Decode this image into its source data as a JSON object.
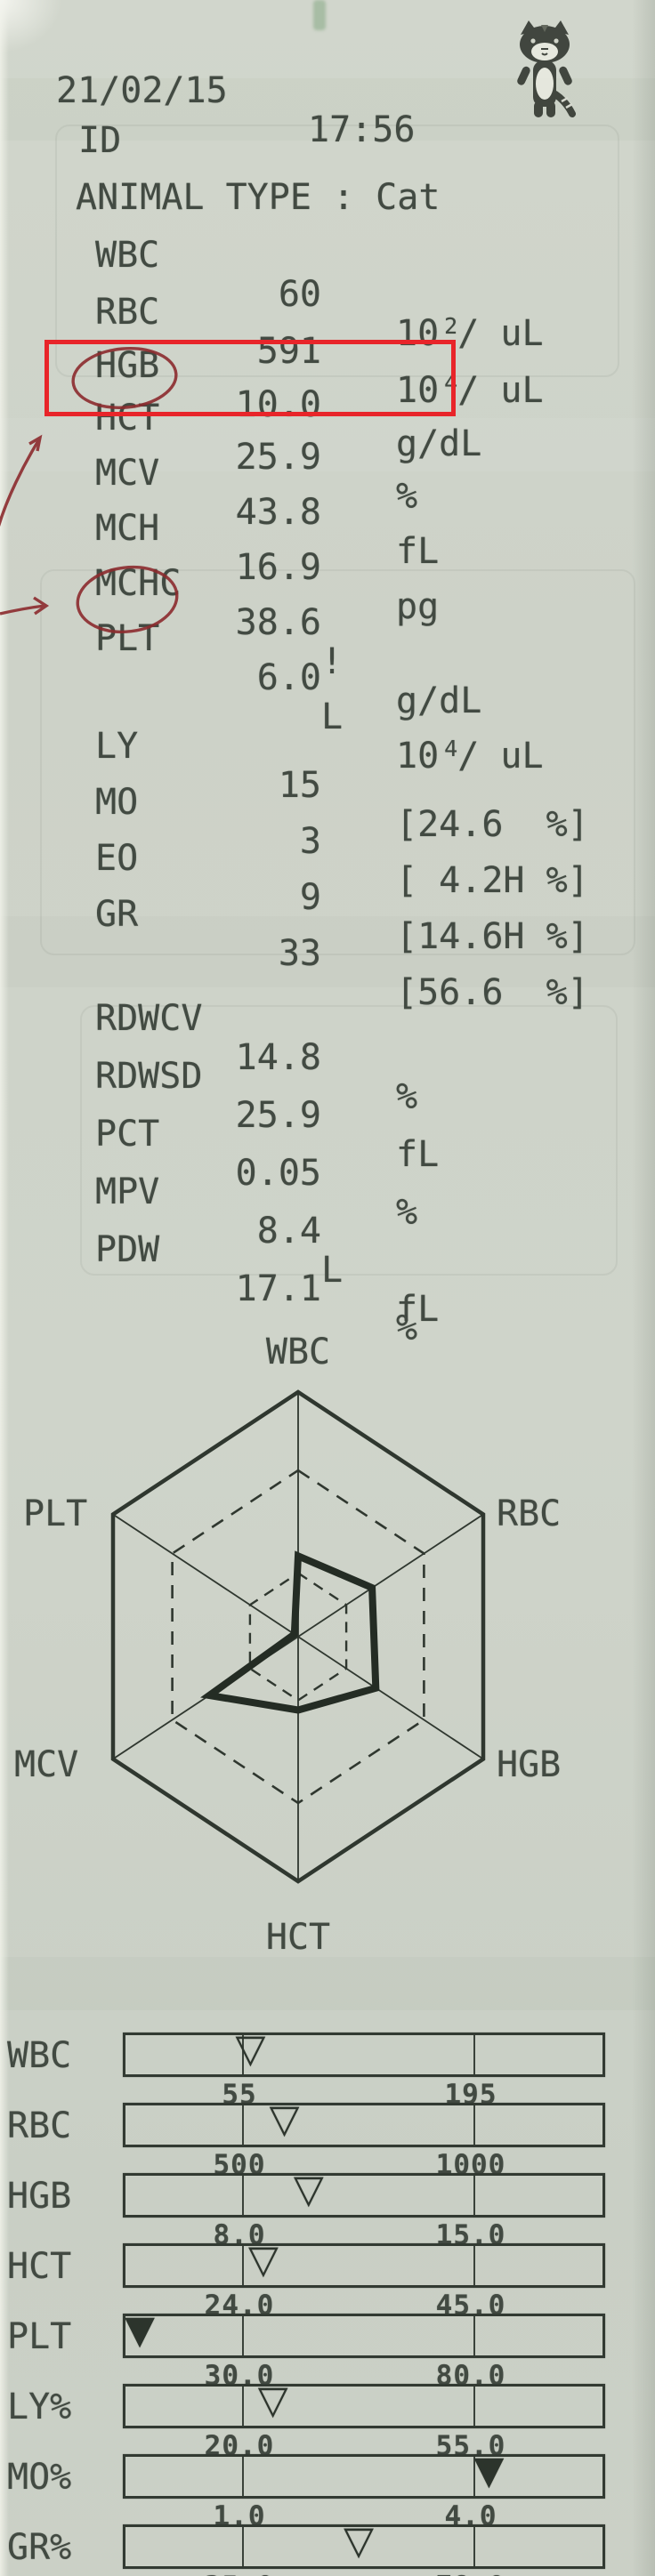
{
  "palette": {
    "paper": "#cdd2c8",
    "ink": "#424a42",
    "line_ink": "#323a32",
    "highlight_red": "#e8252a",
    "pen_dark_red": "#8c2b2e"
  },
  "header": {
    "date": "21/02/15",
    "time": "17:56",
    "mascot": "cat-mascot-stamp"
  },
  "id_line": {
    "label": "ID"
  },
  "animal_line": {
    "text": "ANIMAL TYPE : Cat"
  },
  "cbc_rows": [
    {
      "label": "WBC",
      "value": "60",
      "flag": "",
      "unit_base": "10",
      "unit_sup": "2",
      "unit_rest": "/ uL",
      "unit_text": ""
    },
    {
      "label": "RBC",
      "value": "591",
      "flag": "",
      "unit_base": "10",
      "unit_sup": "4",
      "unit_rest": "/ uL",
      "unit_text": ""
    },
    {
      "label": "HGB",
      "value": "10.0",
      "flag": "",
      "unit_base": "",
      "unit_sup": "",
      "unit_rest": "",
      "unit_text": "g/dL"
    },
    {
      "label": "HCT",
      "value": "25.9",
      "flag": "",
      "unit_base": "",
      "unit_sup": "",
      "unit_rest": "",
      "unit_text": "%"
    },
    {
      "label": "MCV",
      "value": "43.8",
      "flag": "",
      "unit_base": "",
      "unit_sup": "",
      "unit_rest": "",
      "unit_text": "fL"
    },
    {
      "label": "MCH",
      "value": "16.9",
      "flag": "",
      "unit_base": "",
      "unit_sup": "",
      "unit_rest": "",
      "unit_text": "pg"
    },
    {
      "label": "MCHC",
      "value": "38.6",
      "flag": "!",
      "unit_base": "",
      "unit_sup": "",
      "unit_rest": "",
      "unit_text": "g/dL"
    },
    {
      "label": "PLT",
      "value": "6.0",
      "flag": "L",
      "unit_base": "10",
      "unit_sup": "4",
      "unit_rest": "/ uL",
      "unit_text": ""
    }
  ],
  "diff_rows": [
    {
      "label": "LY",
      "value": "15",
      "bracket": "[24.6  %]"
    },
    {
      "label": "MO",
      "value": "3",
      "bracket": "[ 4.2H %]"
    },
    {
      "label": "EO",
      "value": "9",
      "bracket": "[14.6H %]"
    },
    {
      "label": "GR",
      "value": "33",
      "bracket": "[56.6  %]"
    }
  ],
  "extra_rows": [
    {
      "label": "RDWCV",
      "value": "14.8",
      "flag": "",
      "unit_text": "%"
    },
    {
      "label": "RDWSD",
      "value": "25.9",
      "flag": "",
      "unit_text": "fL"
    },
    {
      "label": "PCT",
      "value": "0.05",
      "flag": "",
      "unit_text": "%"
    },
    {
      "label": "MPV",
      "value": "8.4",
      "flag": "L",
      "unit_text": "fL"
    },
    {
      "label": "PDW",
      "value": "17.1",
      "flag": "",
      "unit_text": "%"
    }
  ],
  "annotations": {
    "highlight_box_row": "HCT",
    "circled_labels": [
      "HCT",
      "PLT"
    ],
    "hand_arrows": [
      "arrow-to-HCT-box",
      "arrow-to-PLT-row"
    ]
  },
  "radar": {
    "axes": [
      "WBC",
      "RBC",
      "HGB",
      "HCT",
      "MCV",
      "PLT"
    ],
    "values_frac": [
      0.33,
      0.4,
      0.42,
      0.3,
      0.48,
      0.02
    ]
  },
  "bars": [
    {
      "label": "WBC",
      "low": "55",
      "high": "195",
      "marker_frac": 0.262,
      "marker_glyph": "▽"
    },
    {
      "label": "RBC",
      "low": "500",
      "high": "1000",
      "marker_frac": 0.333,
      "marker_glyph": "▽"
    },
    {
      "label": "HGB",
      "low": "8.0",
      "high": "15.0",
      "marker_frac": 0.384,
      "marker_glyph": "▽"
    },
    {
      "label": "HCT",
      "low": "24.0",
      "high": "45.0",
      "marker_frac": 0.289,
      "marker_glyph": "▽"
    },
    {
      "label": "PLT",
      "low": "30.0",
      "high": "80.0",
      "marker_frac": 0.03,
      "marker_glyph": "▼"
    },
    {
      "label": "LY%",
      "low": "20.0",
      "high": "55.0",
      "marker_frac": 0.309,
      "marker_glyph": "▽"
    },
    {
      "label": "MO%",
      "low": "1.0",
      "high": "4.0",
      "marker_frac": 0.762,
      "marker_glyph": "▼"
    },
    {
      "label": "GR%",
      "low": "35.0",
      "high": "78.0",
      "marker_frac": 0.489,
      "marker_glyph": "▽"
    }
  ],
  "chart_data": [
    {
      "type": "radar",
      "title": "CBC hexagon plot",
      "axes": [
        "WBC",
        "RBC",
        "HGB",
        "HCT",
        "MCV",
        "PLT"
      ],
      "values": [
        60,
        591,
        10.0,
        25.9,
        43.8,
        6.0
      ],
      "values_fraction_of_axis": [
        0.33,
        0.4,
        0.42,
        0.3,
        0.48,
        0.02
      ],
      "rings": "outer solid hexagon = scale max; dashed hexagons at ~0.68 and ~0.26 = reference band",
      "legend_position": "axis labels around hexagon"
    },
    {
      "type": "bar",
      "subtype": "reference-range indicator strips, triangle marker = measured value (filled = out of range)",
      "rows": [
        {
          "label": "WBC",
          "low": 55,
          "high": 195,
          "value": 60,
          "status": "in-range"
        },
        {
          "label": "RBC",
          "low": 500,
          "high": 1000,
          "value": 591,
          "status": "in-range"
        },
        {
          "label": "HGB",
          "low": 8.0,
          "high": 15.0,
          "value": 10.0,
          "status": "in-range"
        },
        {
          "label": "HCT",
          "low": 24.0,
          "high": 45.0,
          "value": 25.9,
          "status": "in-range"
        },
        {
          "label": "PLT",
          "low": 30.0,
          "high": 80.0,
          "value": 6.0,
          "status": "below-range"
        },
        {
          "label": "LY%",
          "low": 20.0,
          "high": 55.0,
          "value": 24.6,
          "status": "in-range"
        },
        {
          "label": "MO%",
          "low": 1.0,
          "high": 4.0,
          "value": 4.2,
          "status": "above-range"
        },
        {
          "label": "GR%",
          "low": 35.0,
          "high": 78.0,
          "value": 56.6,
          "status": "in-range"
        }
      ]
    }
  ]
}
